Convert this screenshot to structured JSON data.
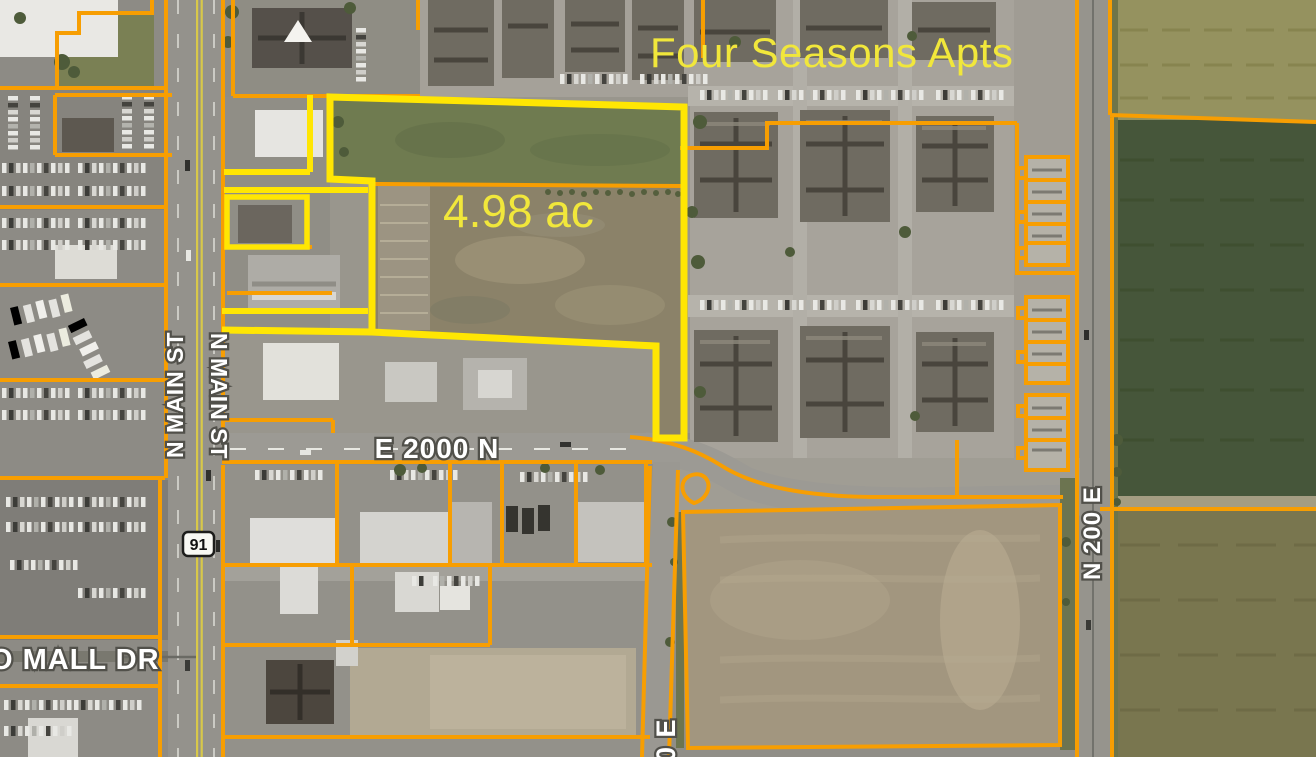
{
  "labels": {
    "apartments_name": "Four Seasons Apts",
    "parcel_area": "4.98 ac",
    "road_e_2000_n": "E 2000 N",
    "road_n_200_e": "N 200 E",
    "road_n_main_st_west": "N MAIN ST",
    "road_n_main_st_east": "N MAIN ST",
    "route_shield_91": "91",
    "road_mall_dr": "O MALL DR",
    "road_00_e": "00 E"
  },
  "colors": {
    "highlight_parcel_outline": "#FFE603",
    "parcel_boundary_orange": "#F79E02",
    "annotation_yellow_text": "#F1E73B",
    "road_label_white": "#FFFFFF",
    "road_label_outline": "#51504A"
  }
}
